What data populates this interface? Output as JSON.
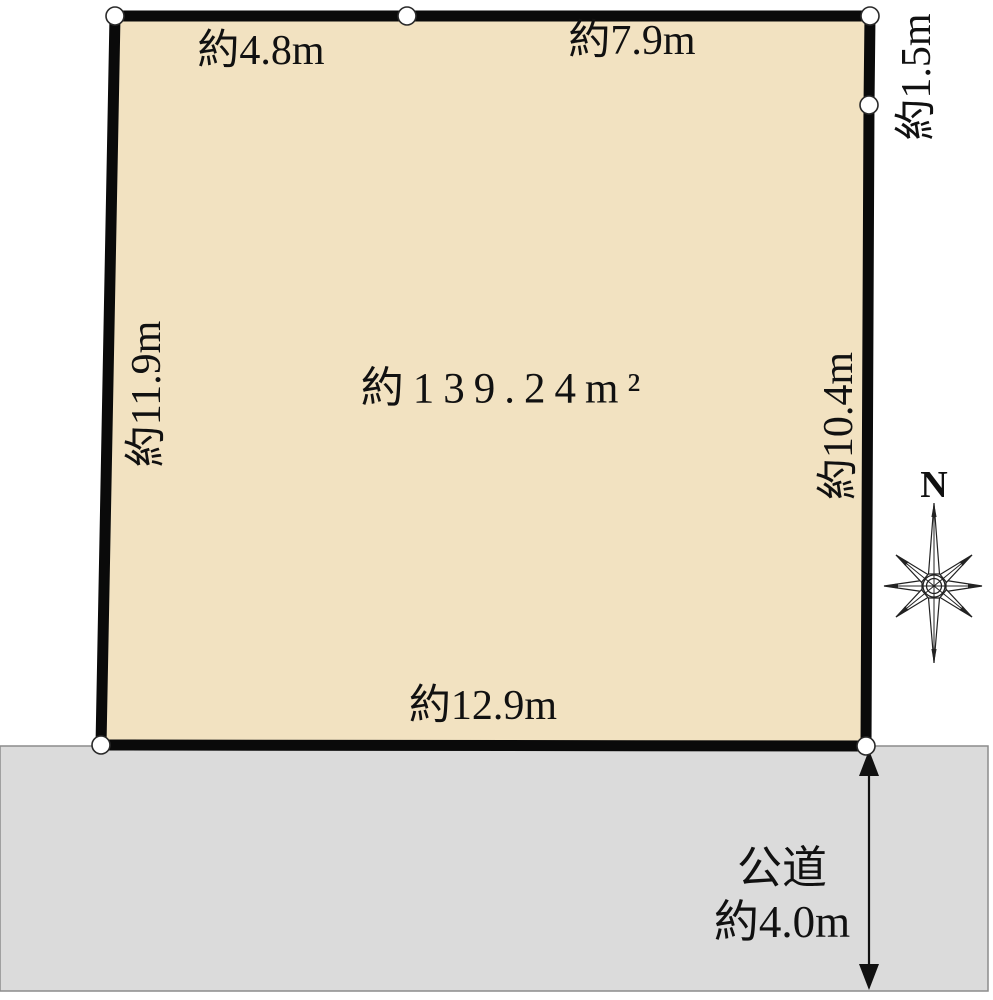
{
  "plot": {
    "area_label": "約139.24m²",
    "dimensions": {
      "top_left": "約4.8m",
      "top_right": "約7.9m",
      "right_upper": "約1.5m",
      "right_lower": "約10.4m",
      "left": "約11.9m",
      "bottom": "約12.9m"
    }
  },
  "road": {
    "name": "公道",
    "width_label": "約4.0m"
  },
  "compass": {
    "north": "N"
  },
  "colors": {
    "plot_fill": "#F2E2C1",
    "plot_outline": "#0A0A0A",
    "road_fill": "#DBDBDB",
    "road_border": "#8C8C8C",
    "text": "#111111"
  }
}
